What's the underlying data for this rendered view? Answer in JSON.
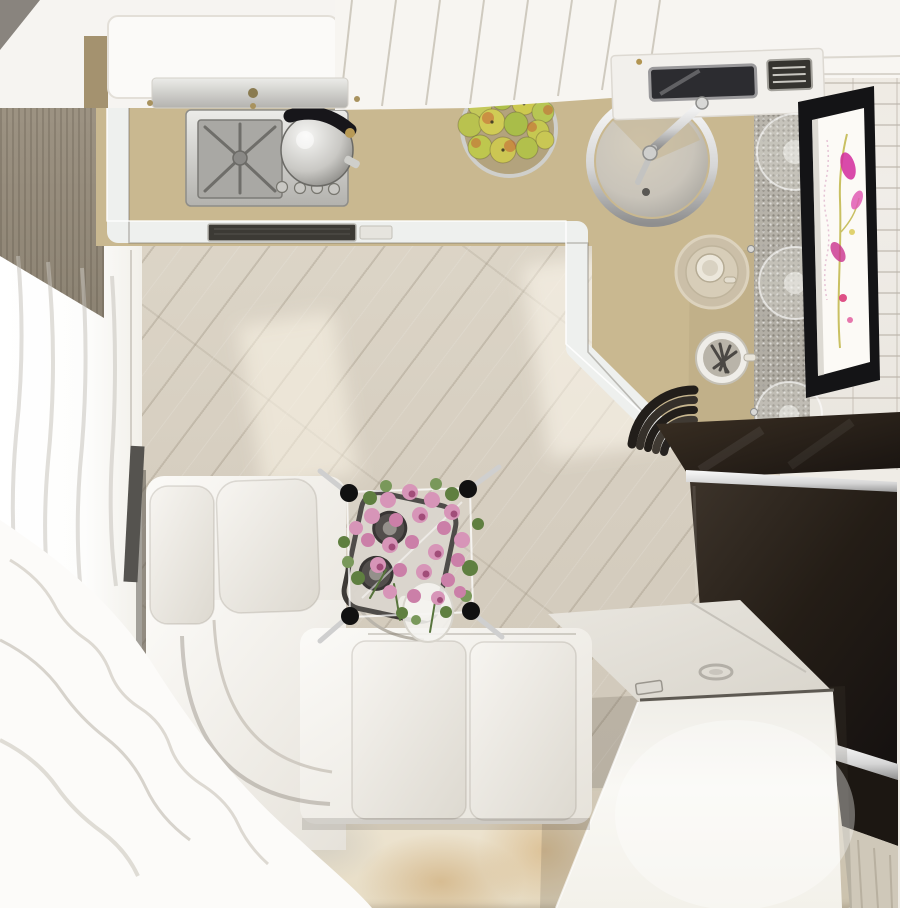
{
  "scene": {
    "description": "Top-down 3D render of a compact studio room combining a kitchen corner, a white corner sofa with a glass coffee table holding a pink tulip bouquet, a white storage chest and a dark desk, seen from directly above.",
    "view": "top-down interior visualization",
    "objects": [
      {
        "label": "light wood plank floor laid diagonally",
        "color": "#d8d0c1"
      },
      {
        "label": "sunlight patches on floor",
        "color": "#fff7e6"
      },
      {
        "label": "beige watercolor area rug",
        "color": "#ebe2cd"
      },
      {
        "label": "sheer white window curtains, left wall",
        "color": "#fcfbf9"
      },
      {
        "label": "textured taupe wall strip, upper left",
        "color": "#9b9183"
      },
      {
        "label": "beige L-shaped kitchen countertop",
        "color": "#c9b890"
      },
      {
        "label": "white counter edge trim",
        "color": "#eef0ee"
      },
      {
        "label": "dark vent grille in cabinet band",
        "color": "#3c3a35"
      },
      {
        "label": "stainless gas hob with burner grate",
        "color": "#c6c5c1"
      },
      {
        "label": "polished steel kettle on hob",
        "color": "#d9d8d4"
      },
      {
        "label": "wire bowl of green-yellow apples",
        "color": "#bfca52"
      },
      {
        "label": "round stainless sink",
        "color": "#c2bfb8"
      },
      {
        "label": "chrome faucet over sink",
        "color": "#cfcfcd"
      },
      {
        "label": "built-in microwave and vent unit",
        "color": "#2a2a2c"
      },
      {
        "label": "glass shelf plates on speckled panel",
        "color": "#e6e4de"
      },
      {
        "label": "cup and saucer on counter",
        "color": "#d8cdbA"
      },
      {
        "label": "utensil cup with spoons",
        "color": "#efede8"
      },
      {
        "label": "stack of dark bowls at counter corner",
        "color": "#26221e"
      },
      {
        "label": "white slatted ceiling panels over kitchen",
        "color": "#f8f6f2"
      },
      {
        "label": "white brick wall, right side",
        "color": "#efece6"
      },
      {
        "label": "wall screen with magenta flower artwork",
        "color": "#d22a9c"
      },
      {
        "label": "dark glossy bench top",
        "color": "#2c241c"
      },
      {
        "label": "dark brown desk surface with chrome trim",
        "color": "#2e261e"
      },
      {
        "label": "white storage chest bench",
        "color": "#f5f3ee"
      },
      {
        "label": "white leather corner sofa",
        "color": "#f4f2ee"
      },
      {
        "label": "square glass coffee table with black corner pads",
        "color": "#e8ecef"
      },
      {
        "label": "serving tray with two dark cups under table",
        "color": "#d8d3c9"
      },
      {
        "label": "bouquet of pink tulips in white vase",
        "color": "#d795b8"
      },
      {
        "label": "flowing ruffled curtain, lower left",
        "color": "#fcfbf9"
      }
    ]
  },
  "palette": {
    "ceiling": "#f8f6f2",
    "counter": "#c9b890",
    "trim": "#eef0ee",
    "floor": "#d8d0c1",
    "sofa": "#f4f2ee",
    "chest": "#f5f3ee",
    "desk": "#2e261e",
    "chrome": "#e9e9e9",
    "tvFrame": "#141416",
    "tvScreen": "#fcfaf6",
    "flowerMagenta": "#d22a9c",
    "tulipPink": "#d795b8",
    "leaf": "#6a8a4a",
    "apple": "#bfca52",
    "brick": "#efece6",
    "wallLeft": "#9b9183",
    "speckle": "#b4b0a7",
    "curtain": "#fcfbf9",
    "rug": "#ebe2cd"
  }
}
